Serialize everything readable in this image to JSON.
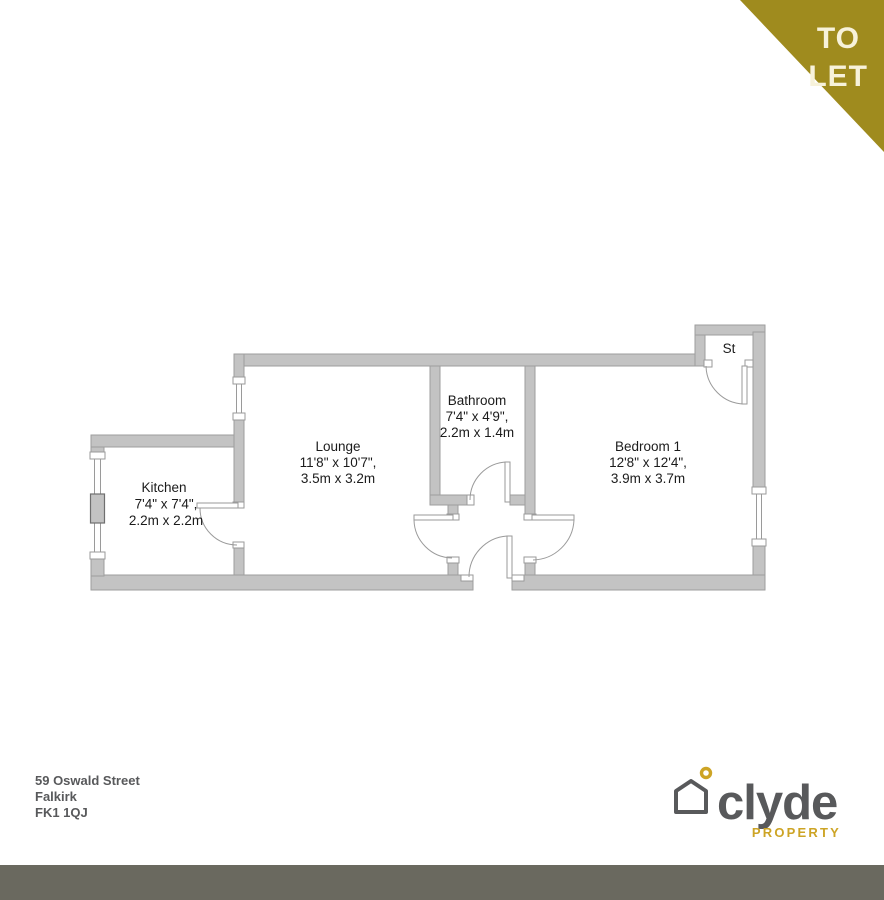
{
  "banner": {
    "line1": "TO",
    "line2": "LET"
  },
  "floorplan": {
    "rooms": {
      "kitchen": {
        "name": "Kitchen",
        "imperial": "7'4\" x 7'4\",",
        "metric": "2.2m x 2.2m"
      },
      "lounge": {
        "name": "Lounge",
        "imperial": "11'8\" x 10'7\",",
        "metric": "3.5m x 3.2m"
      },
      "bathroom": {
        "name": "Bathroom",
        "imperial": "7'4\" x 4'9\",",
        "metric": "2.2m x 1.4m"
      },
      "bedroom1": {
        "name": "Bedroom 1",
        "imperial": "12'8\" x 12'4\",",
        "metric": "3.9m x 3.7m"
      },
      "storage": {
        "name": "St"
      }
    }
  },
  "address": {
    "line1": "59 Oswald Street",
    "line2": "Falkirk",
    "line3": "FK1 1QJ"
  },
  "logo": {
    "brand": "clyde",
    "tagline": "PROPERTY"
  },
  "colors": {
    "banner_gold": "#9f8b1e",
    "banner_text": "#f7f2da",
    "wall_fill": "#c3c3c3",
    "brand_gray": "#58595b",
    "brand_gold": "#cda425",
    "footer_strip": "#6a695f"
  }
}
